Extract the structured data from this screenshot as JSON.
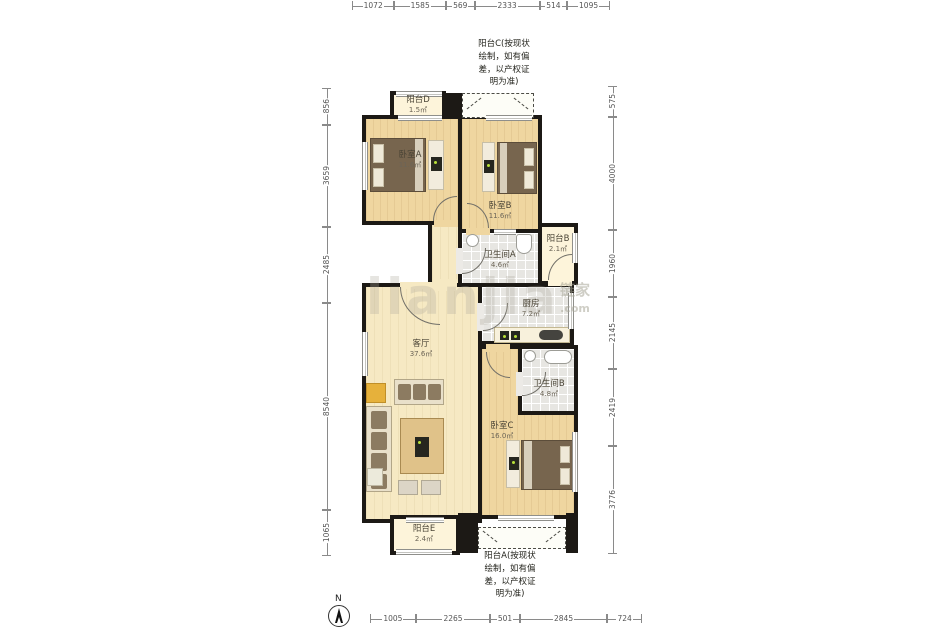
{
  "north_label": "N",
  "watermark": {
    "big": "lianjia",
    "cn": "链家",
    "suffix": ".com"
  },
  "dimensions": {
    "top": [
      1072,
      1585,
      569,
      2333,
      514,
      1095
    ],
    "bottom": [
      1005,
      2265,
      501,
      2845,
      724
    ],
    "left": [
      856,
      3659,
      2485,
      8540,
      1065
    ],
    "right": [
      575,
      4000,
      1960,
      2145,
      2419,
      3776
    ]
  },
  "rooms": [
    {
      "id": "balcony-d",
      "name": "阳台D",
      "area": "1.5㎡"
    },
    {
      "id": "bedroom-a",
      "name": "卧室A",
      "area": "11.6㎡"
    },
    {
      "id": "bedroom-b",
      "name": "卧室B",
      "area": "11.6㎡"
    },
    {
      "id": "balcony-b",
      "name": "阳台B",
      "area": "2.1㎡"
    },
    {
      "id": "bathroom-a",
      "name": "卫生间A",
      "area": "4.6㎡"
    },
    {
      "id": "kitchen",
      "name": "厨房",
      "area": "7.2㎡"
    },
    {
      "id": "living-room",
      "name": "客厅",
      "area": "37.6㎡"
    },
    {
      "id": "bathroom-b",
      "name": "卫生间B",
      "area": "4.8㎡"
    },
    {
      "id": "bedroom-c",
      "name": "卧室C",
      "area": "16.0㎡"
    },
    {
      "id": "balcony-e",
      "name": "阳台E",
      "area": "2.4㎡"
    }
  ],
  "notes": {
    "balcony_c": "阳台C(按现状\n绘制，如有偏\n差，以产权证\n明为准)",
    "balcony_a": "阳台A(按现状\n绘制，如有偏\n差，以产权证\n明为准)"
  }
}
